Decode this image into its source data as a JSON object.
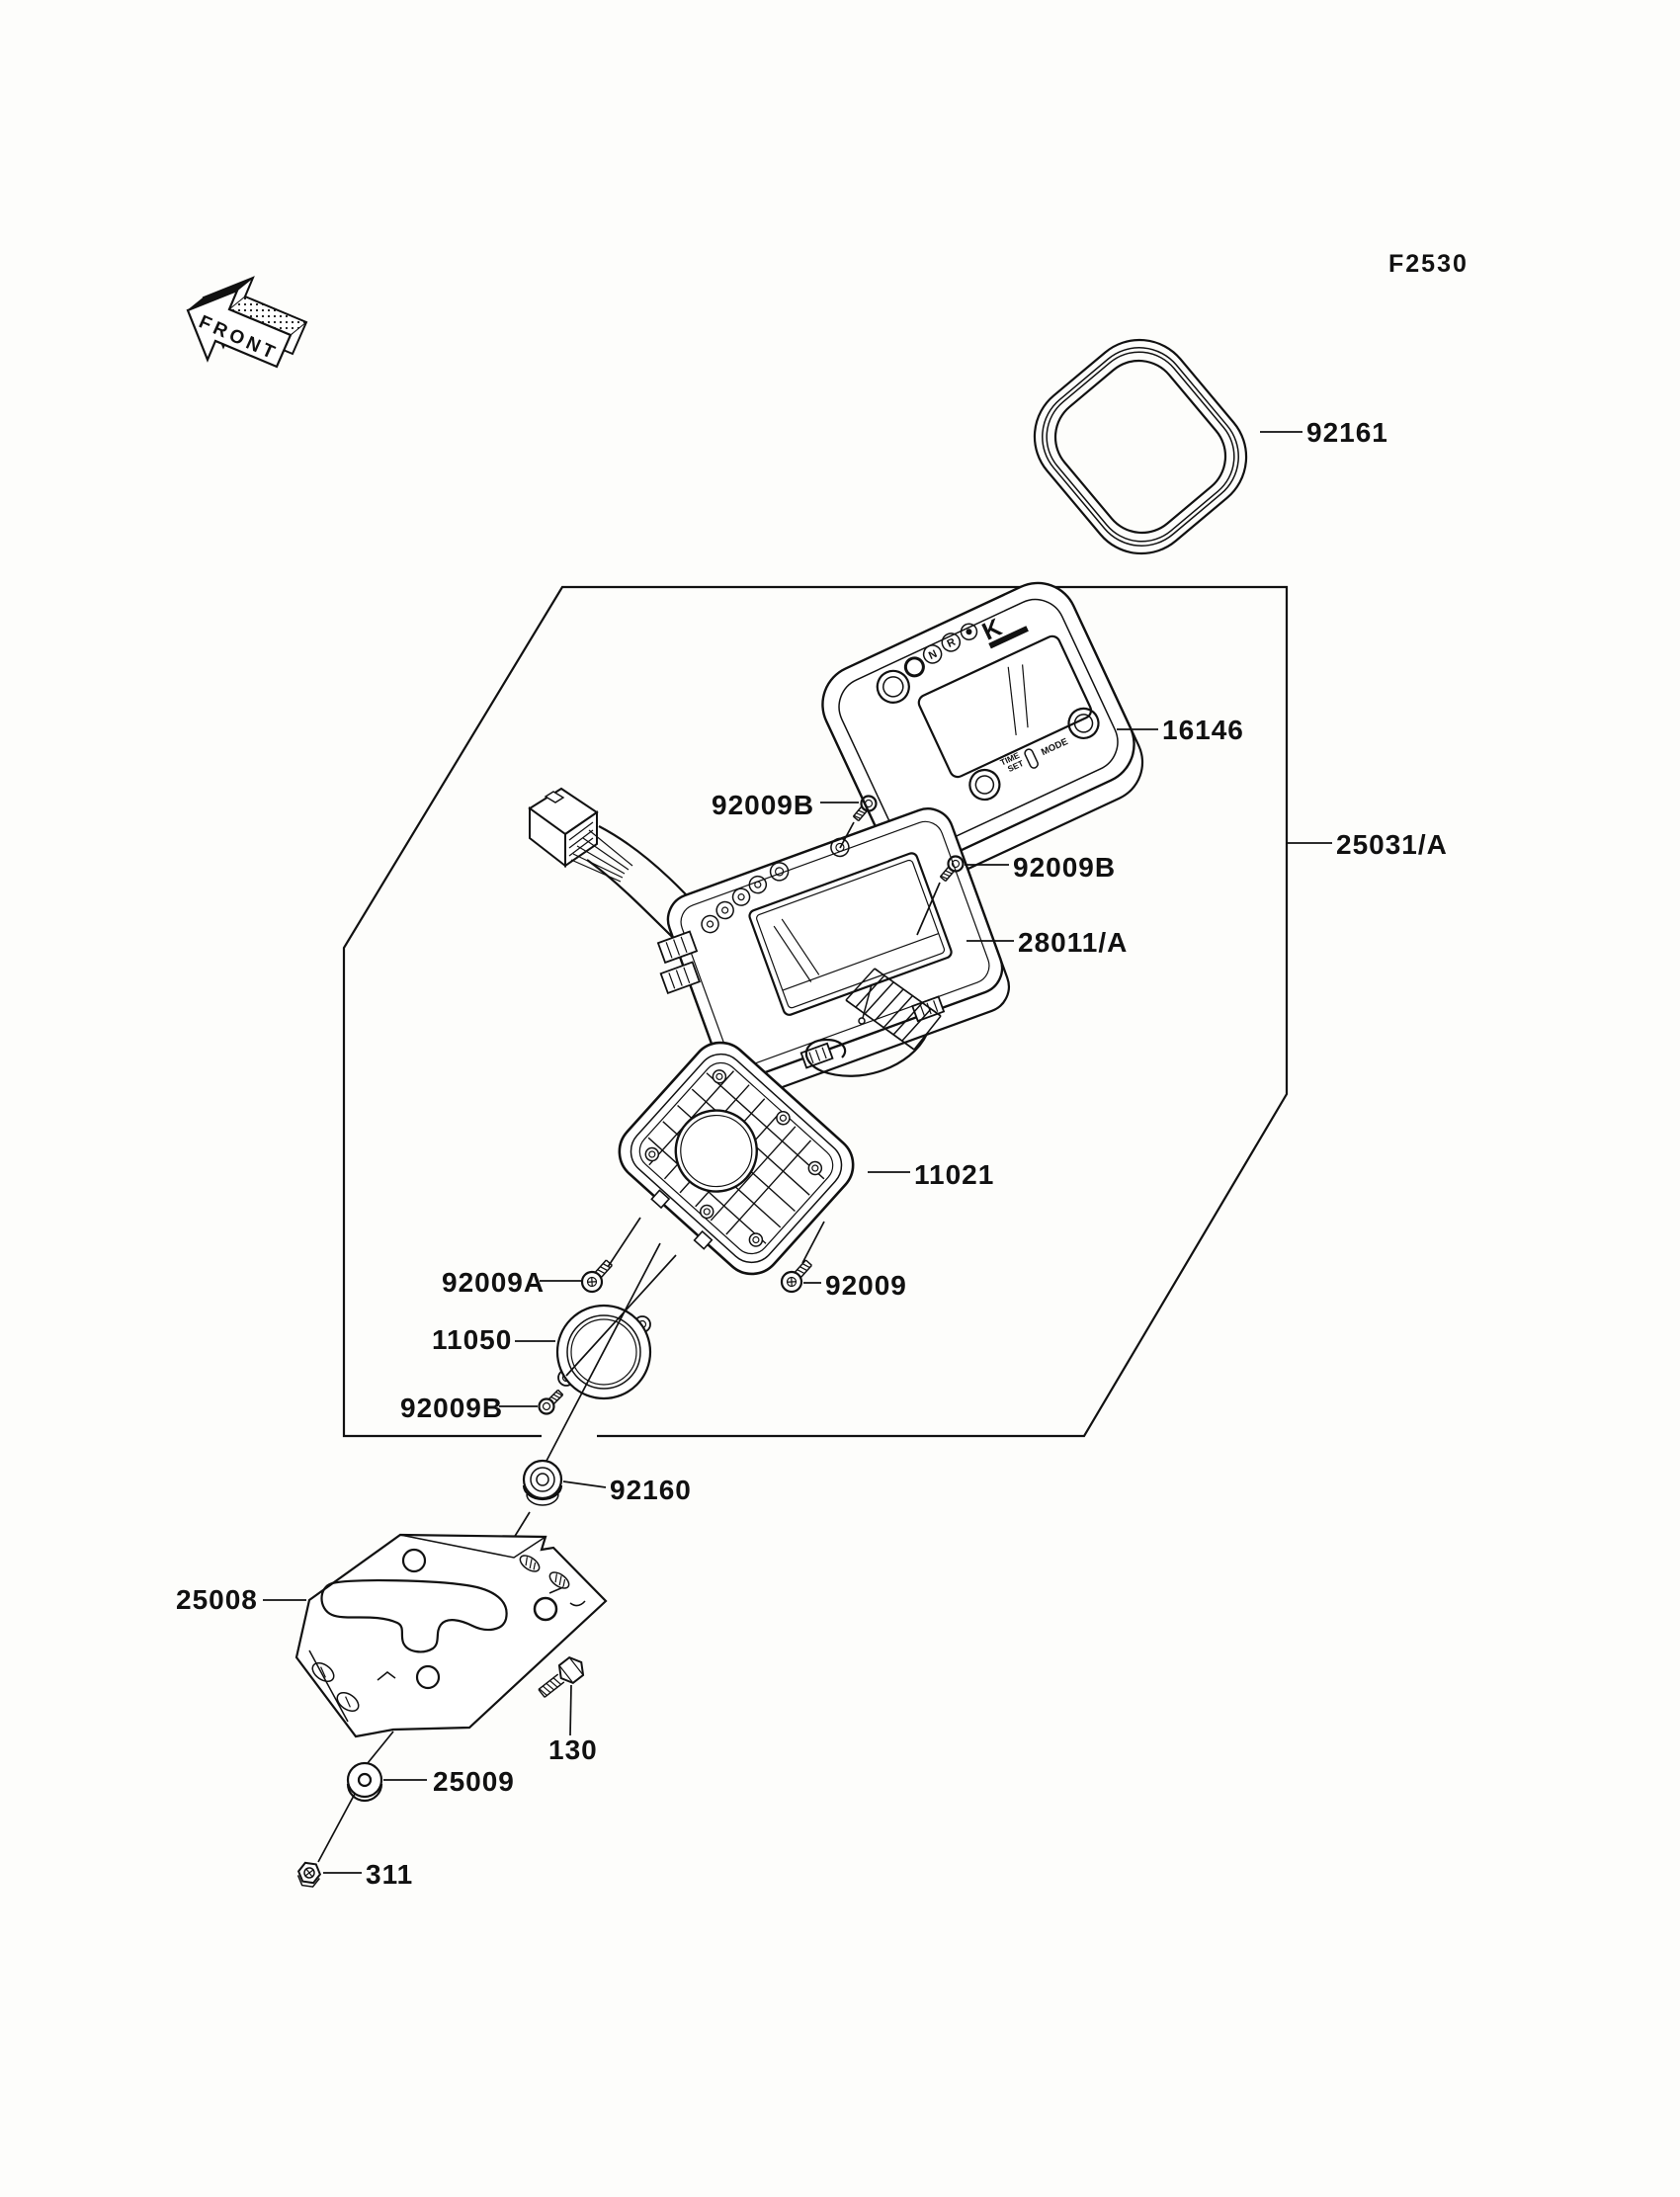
{
  "page": {
    "diagram_code": "F2530",
    "front_marker": "FRONT"
  },
  "meter_face": {
    "logo": "K",
    "indicator_n": "N",
    "indicator_r": "R",
    "mode_button": "MODE",
    "time_label": "TIME",
    "set_label": "SET"
  },
  "parts": {
    "cover_ring": "92161",
    "meter_cover": "16146",
    "screw_92009b_top": "92009B",
    "screw_92009b_right": "92009B",
    "meter_assembly": "25031/A",
    "meter_unit": "28011/A",
    "meter_case": "11021",
    "screw_92009a": "92009A",
    "screw_92009": "92009",
    "bracket_ring": "11050",
    "screw_92009b_lower": "92009B",
    "damper": "92160",
    "bracket": "25008",
    "bolt": "130",
    "washer": "25009",
    "nut": "311"
  }
}
